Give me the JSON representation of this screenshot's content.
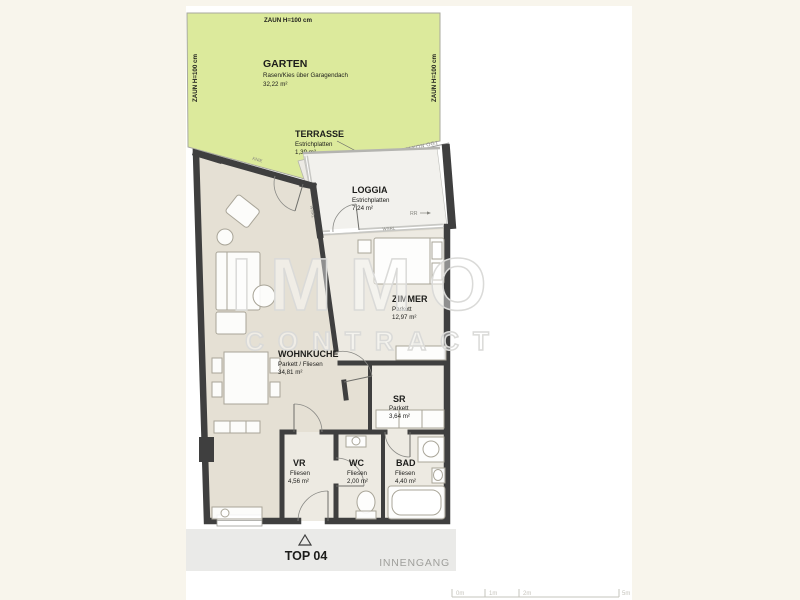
{
  "colors": {
    "bg": "#f8f5ec",
    "canvas": "#ffffff",
    "garden": "#dcea9c",
    "gardenLine": "#a8a89e",
    "floor": "#e5e0d4",
    "floorLight": "#edeae2",
    "loggiaFloor": "#f2f1ed",
    "terraceFloor": "#eceae4",
    "wall": "#3f3f3f",
    "window": "#c8c8c4",
    "furn": "#a9a598",
    "ink": "#1d1d1b",
    "grayText": "#9f9f9b",
    "band": "#eaeae8",
    "scale": "#c6c4bc",
    "watermark": "#dadad8"
  },
  "garden": {
    "name": "GARTEN",
    "desc": "Rasen/Kies über Garagendach",
    "area": "32,22 m²",
    "fence_top": "ZAUN H=100 cm",
    "fence_left": "ZAUN H=100 cm",
    "fence_right": "ZAUN H=100 cm"
  },
  "terrace": {
    "name": "TERRASSE",
    "material": "Estrichplatten",
    "area": "1,39 m²"
  },
  "loggia": {
    "name": "LOGGIA",
    "material": "Estrichplatten",
    "area": "7,24 m²"
  },
  "annotations": {
    "balcony_edge": "VORDERKANTE BALKON OG1",
    "knie": "KNIE",
    "rr": "RR",
    "window_mark": "WSRL"
  },
  "rooms": {
    "wohnkueche": {
      "name": "WOHNKÜCHE",
      "material": "Parkett / Fliesen",
      "area": "34,81 m²"
    },
    "zimmer": {
      "name": "ZIMMER",
      "material": "Parkett",
      "area": "12,97 m²"
    },
    "sr": {
      "name": "SR",
      "material": "Parkett",
      "area": "3,64 m²"
    },
    "vr": {
      "name": "VR",
      "material": "Fliesen",
      "area": "4,56 m²"
    },
    "wc": {
      "name": "WC",
      "material": "Fliesen",
      "area": "2,00 m²"
    },
    "bad": {
      "name": "BAD",
      "material": "Fliesen",
      "area": "4,40 m²"
    }
  },
  "footer": {
    "unit": "TOP 04",
    "corridor": "INNENGANG"
  },
  "watermark": {
    "line1": "IMMO",
    "line2": "CONTRACT"
  },
  "scalebar": {
    "labels": [
      "0m",
      "1m",
      "2m",
      "5m"
    ]
  }
}
